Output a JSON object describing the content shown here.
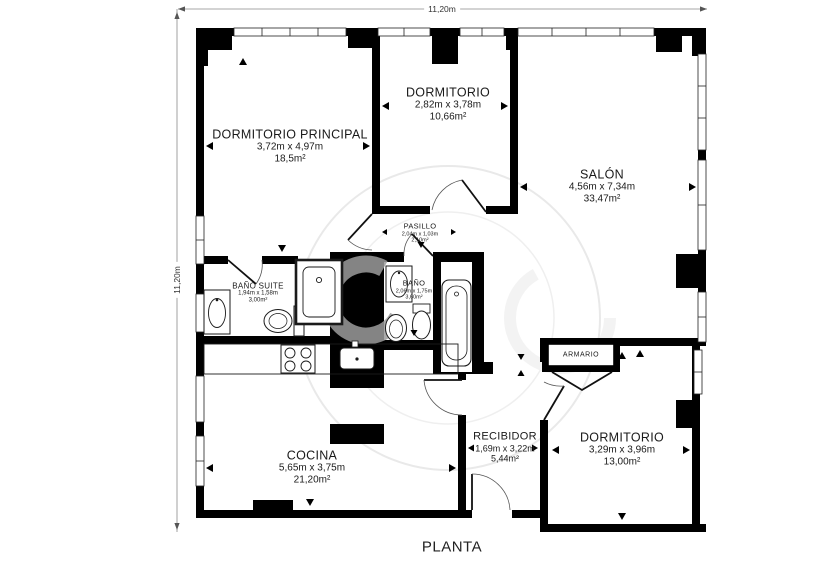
{
  "title": "PLANTA",
  "dimensions": {
    "top": "11,20m",
    "left": "11,20m"
  },
  "rooms": [
    {
      "id": "dormitorio-principal",
      "name": "DORMITORIO PRINCIPAL",
      "size": "3,72m x 4,97m",
      "area": "18,5m²"
    },
    {
      "id": "dormitorio",
      "name": "DORMITORIO",
      "size": "2,82m x 3,78m",
      "area": "10,66m²"
    },
    {
      "id": "salon",
      "name": "SALÓN",
      "size": "4,56m x 7,34m",
      "area": "33,47m²"
    },
    {
      "id": "pasillo",
      "name": "PASILLO",
      "size": "2,04m x 1,03m",
      "area": "2,10m²"
    },
    {
      "id": "bano-suite",
      "name": "BAÑO SUITE",
      "size": "1,94m x 1,58m",
      "area": "3,00m²"
    },
    {
      "id": "bano",
      "name": "BAÑO",
      "size": "2,06m x 1,75m",
      "area": "3,60m²"
    },
    {
      "id": "armario",
      "name": "ARMARIO",
      "size": "",
      "area": ""
    },
    {
      "id": "cocina",
      "name": "COCINA",
      "size": "5,65m x 3,75m",
      "area": "21,20m²"
    },
    {
      "id": "recibidor",
      "name": "RECIBIDOR",
      "size": "1,69m x 3,22m",
      "area": "5,44m²"
    },
    {
      "id": "dormitorio-2",
      "name": "DORMITORIO",
      "size": "3,29m x 3,96m",
      "area": "13,00m²"
    }
  ],
  "fixtures": [
    "shower",
    "washbasin",
    "toilet",
    "bidet",
    "bathtub",
    "stove",
    "kitchen-sink",
    "kitchen-island"
  ],
  "colors": {
    "wall": "#000000",
    "text": "#1a1a1a",
    "watermark": "#ebebeb",
    "watermark_glyph": "#9b9b9b"
  }
}
